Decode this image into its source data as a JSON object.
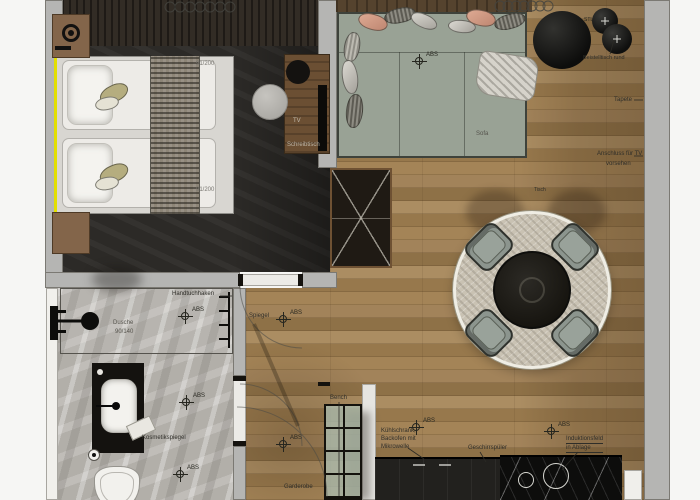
{
  "bedroom": {
    "mattress_dim": "91/200",
    "tv_label": "TV",
    "desk_label": "Schreibtisch"
  },
  "living": {
    "sofa_label": "Sofa",
    "stl_label": "STL",
    "side_table_label": "Beistelltisch rund",
    "wallpaper_label": "Tapete",
    "tv_connection_1": "Anschluss für TV",
    "tv_connection_2": "vorsehen",
    "table_label": "Tisch"
  },
  "bathroom": {
    "shower_label": "Dusche",
    "shower_dim": "90/140",
    "towel_label": "Handtuchhaken",
    "cosmetic_mirror_label": "Kosmetikspiegel"
  },
  "hallway": {
    "mirror_label": "Spiegel",
    "wardrobe_label": "Garderobe",
    "bench_label": "Bench"
  },
  "kitchen": {
    "appliance_line_1": "Kühlschrank,",
    "appliance_line_2": "Backofen mit",
    "appliance_line_3": "Mikrowelle",
    "dishwasher_label": "Geschirrspüler",
    "induction_line_1": "Induktionsfeld",
    "induction_line_2": "in Ablage"
  },
  "symbols": {
    "abs_label": "ABS"
  },
  "colors": {
    "wood": "#9c7f58",
    "walls": "#b5b5b3",
    "sofa": "#99a295",
    "window_accent": "#e3df00",
    "bath_marble": "#b2afa9",
    "counter_marble": "#0d0d0c"
  }
}
